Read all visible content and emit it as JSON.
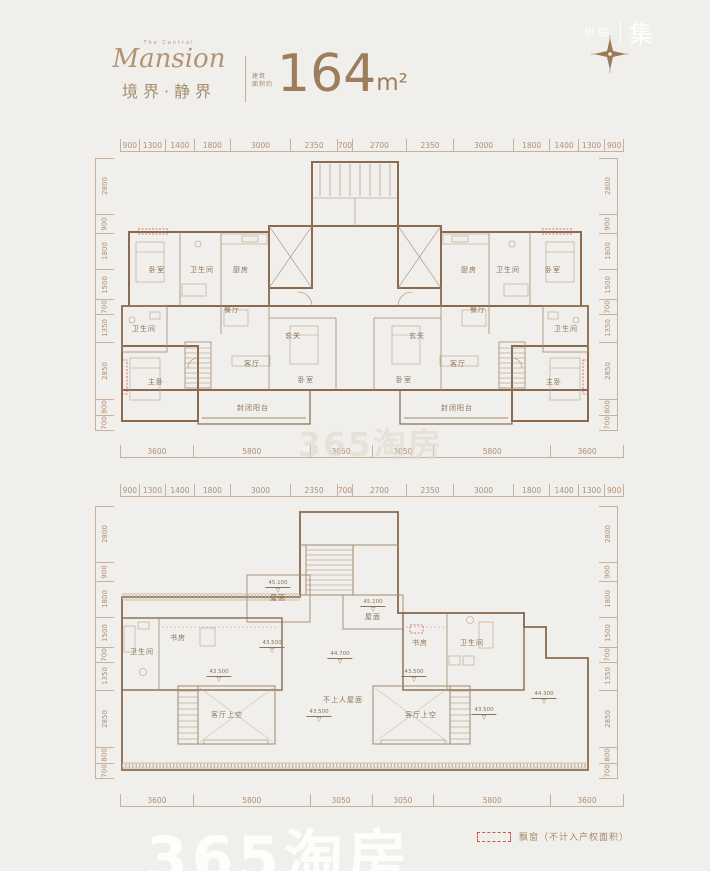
{
  "page": {
    "background": "#f0efec",
    "accent": "#9c7d5c",
    "line_color": "#8a6b4e",
    "dim_color": "#b18f75"
  },
  "header": {
    "tagline": "The Central",
    "logo_script": "Mansion",
    "logo_cn": "境界·静界",
    "area_prefix_line1": "建筑",
    "area_prefix_line2": "面积约",
    "area_value": "164",
    "area_unit": "m²"
  },
  "brand": {
    "left": "世联",
    "right": "集"
  },
  "watermark": {
    "center": "365淘房",
    "bottom": "365淘房"
  },
  "legend": {
    "label": "飘窗（不计入产权面积）"
  },
  "symbols": {
    "elevation_triangle": "▽",
    "compass": "compass-rose"
  },
  "dims": {
    "top": [
      "900",
      "1300",
      "1400",
      "1800",
      "3000",
      "2350",
      "700",
      "2700",
      "2350",
      "3000",
      "1800",
      "1400",
      "1300",
      "900"
    ],
    "bottom": [
      "3600",
      "5800",
      "3050",
      "3050",
      "5800",
      "3600"
    ],
    "side": [
      "2800",
      "900",
      "1800",
      "1500",
      "700",
      "1350",
      "2850",
      "800",
      "700"
    ]
  },
  "plan_upper": {
    "rooms": [
      {
        "text": "卧室",
        "x": 37,
        "y": 112
      },
      {
        "text": "卫生间",
        "x": 82,
        "y": 112
      },
      {
        "text": "厨房",
        "x": 121,
        "y": 112
      },
      {
        "text": "餐厅",
        "x": 112,
        "y": 152
      },
      {
        "text": "玄关",
        "x": 173,
        "y": 178
      },
      {
        "text": "卫生间",
        "x": 24,
        "y": 171
      },
      {
        "text": "主卧",
        "x": 36,
        "y": 224
      },
      {
        "text": "客厅",
        "x": 132,
        "y": 206
      },
      {
        "text": "卧室",
        "x": 186,
        "y": 222
      },
      {
        "text": "封闭阳台",
        "x": 133,
        "y": 250
      },
      {
        "text": "厨房",
        "x": 349,
        "y": 112
      },
      {
        "text": "卫生间",
        "x": 388,
        "y": 112
      },
      {
        "text": "卧室",
        "x": 433,
        "y": 112
      },
      {
        "text": "餐厅",
        "x": 358,
        "y": 152
      },
      {
        "text": "玄关",
        "x": 297,
        "y": 178
      },
      {
        "text": "卫生间",
        "x": 446,
        "y": 171
      },
      {
        "text": "客厅",
        "x": 338,
        "y": 206
      },
      {
        "text": "卧室",
        "x": 284,
        "y": 222
      },
      {
        "text": "主卧",
        "x": 434,
        "y": 224
      },
      {
        "text": "封闭阳台",
        "x": 337,
        "y": 250
      }
    ]
  },
  "plan_lower": {
    "rooms": [
      {
        "text": "屋面",
        "x": 158,
        "y": 92
      },
      {
        "text": "屋面",
        "x": 253,
        "y": 111
      },
      {
        "text": "卫生间",
        "x": 22,
        "y": 146
      },
      {
        "text": "书房",
        "x": 58,
        "y": 132
      },
      {
        "text": "书房",
        "x": 300,
        "y": 137
      },
      {
        "text": "卫生间",
        "x": 352,
        "y": 137
      },
      {
        "text": "客厅上空",
        "x": 107,
        "y": 209
      },
      {
        "text": "客厅上空",
        "x": 301,
        "y": 209
      },
      {
        "text": "不上人屋面",
        "x": 223,
        "y": 194
      }
    ],
    "elevations": [
      {
        "text": "45.100",
        "x": 158,
        "y": 74
      },
      {
        "text": "45.100",
        "x": 253,
        "y": 93
      },
      {
        "text": "43.500",
        "x": 152,
        "y": 134
      },
      {
        "text": "43.500",
        "x": 99,
        "y": 163
      },
      {
        "text": "44.700",
        "x": 220,
        "y": 145
      },
      {
        "text": "43.500",
        "x": 199,
        "y": 203
      },
      {
        "text": "43.500",
        "x": 294,
        "y": 163
      },
      {
        "text": "43.500",
        "x": 364,
        "y": 201
      },
      {
        "text": "44.300",
        "x": 424,
        "y": 185
      }
    ]
  }
}
